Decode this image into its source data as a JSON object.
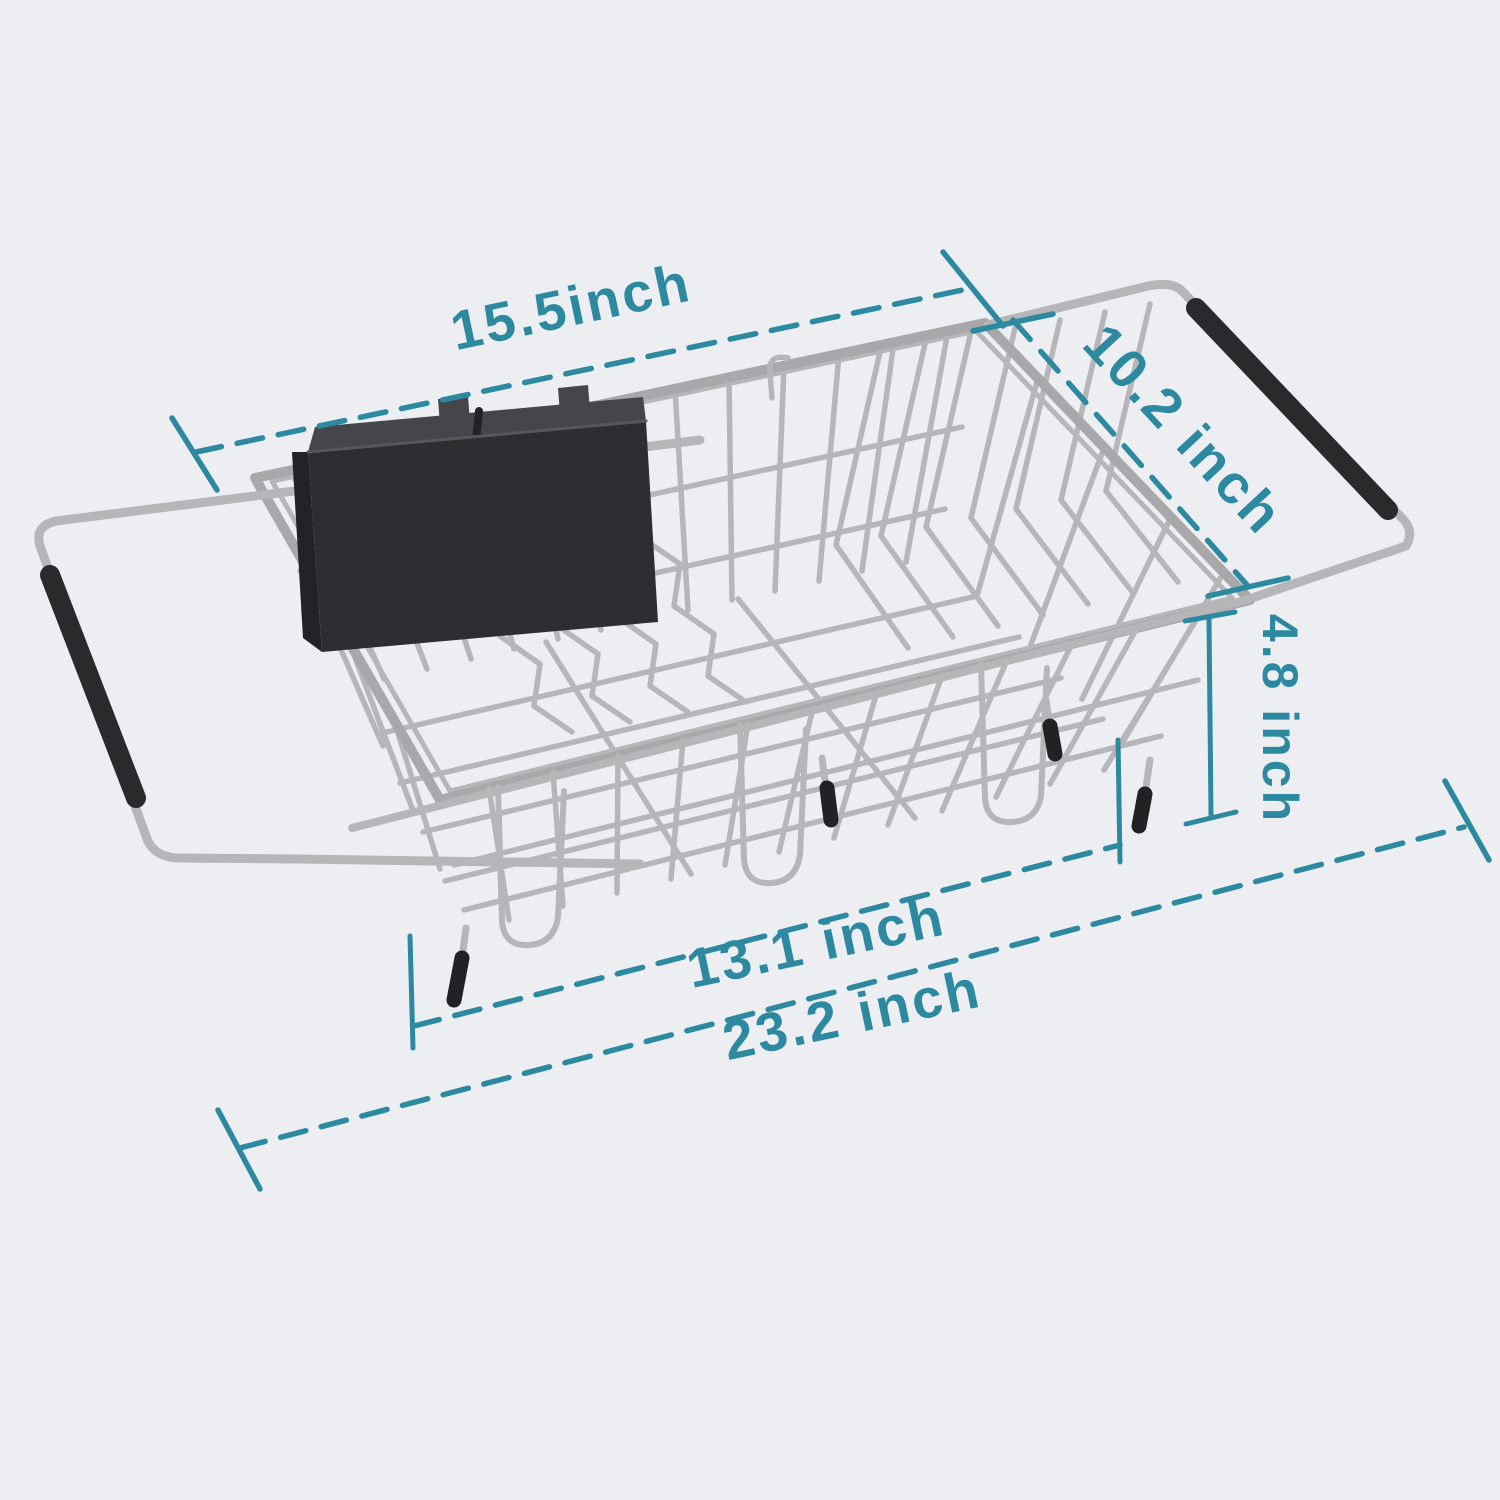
{
  "colors": {
    "background": "#edeef2",
    "accent": "#2c89a0",
    "wire": "#b6b5b7",
    "rim": "#a8a7aa",
    "grip": "#2a2a2d",
    "caddy_front": "#2e2e32",
    "caddy_top": "#45464b",
    "caddy_side": "#232327",
    "caddy_edge": "#56575d",
    "foot_tip": "#222224"
  },
  "dimensions": {
    "top_width": {
      "label": "15.5inch"
    },
    "depth": {
      "label": "10.2 inch"
    },
    "height": {
      "label": "4.8 inch"
    },
    "inner_length": {
      "label": "13.1 inch"
    },
    "overall_length": {
      "label": "23.2 inch"
    }
  }
}
